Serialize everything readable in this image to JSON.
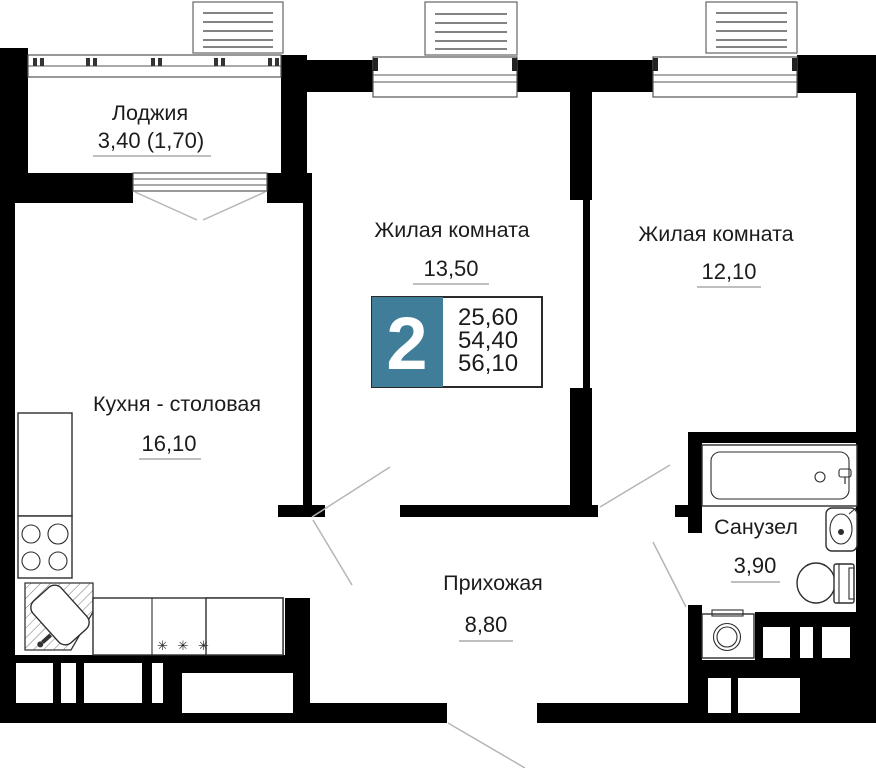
{
  "badge": {
    "number": "2",
    "areas": [
      "25,60",
      "54,40",
      "56,10"
    ],
    "color": "#3F7D98"
  },
  "rooms": {
    "loggia": {
      "name": "Лоджия",
      "area": "3,40 (1,70)"
    },
    "room1": {
      "name": "Жилая комната",
      "area": "13,50"
    },
    "room2": {
      "name": "Жилая комната",
      "area": "12,10"
    },
    "kitchen": {
      "name": "Кухня - столовая",
      "area": "16,10"
    },
    "hallway": {
      "name": "Прихожая",
      "area": "8,80"
    },
    "bathroom": {
      "name": "Санузел",
      "area": "3,90"
    }
  },
  "symbols": {
    "hob_marks": "✳ ✳ ✳"
  },
  "colors": {
    "wall": "#000000",
    "accent": "#3F7D98",
    "text": "#1C1C1C"
  }
}
